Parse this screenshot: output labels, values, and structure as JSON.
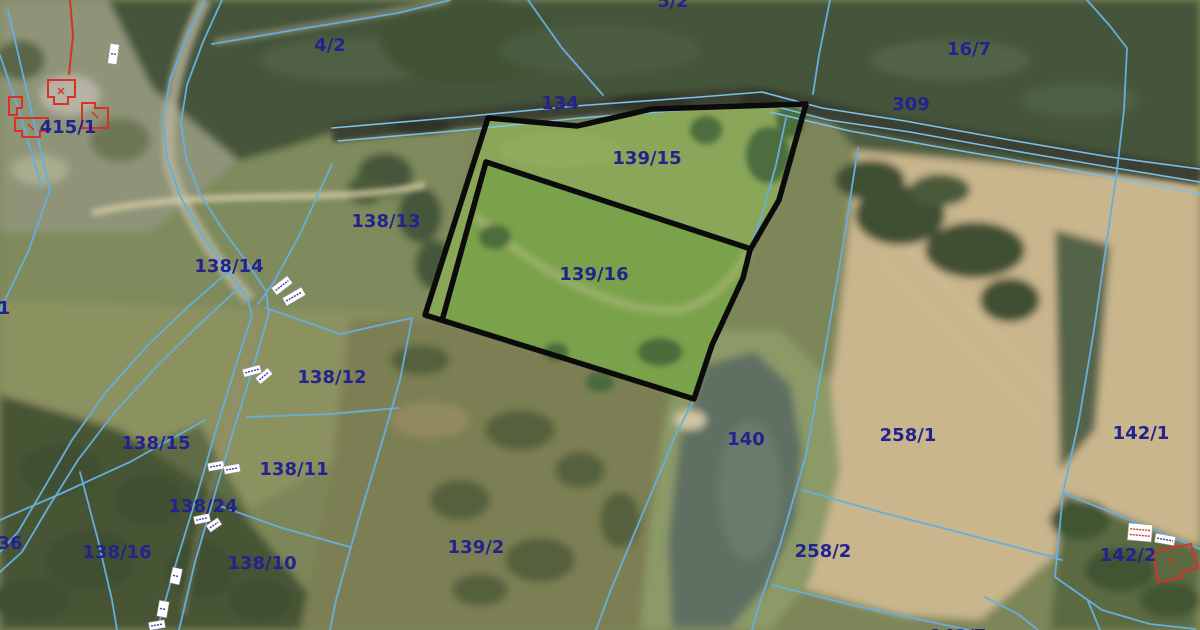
{
  "map": {
    "type": "cadastral-aerial-map",
    "highlighted_parcels": [
      "139/15",
      "139/16"
    ],
    "colors": {
      "boundary_line": "#66aede",
      "label_text": "#23238f",
      "highlight_outline": "#0b0b0b",
      "building_outline": "#d63226",
      "highlight_fill_north": "#8aa658",
      "highlight_fill_south": "#7aa24a"
    },
    "parcel_labels": [
      {
        "text": "415/1",
        "x": 68,
        "y": 128
      },
      {
        "text": "4/2",
        "x": 330,
        "y": 46
      },
      {
        "text": "5/2",
        "x": 673,
        "y": 2
      },
      {
        "text": "134",
        "x": 560,
        "y": 104
      },
      {
        "text": "309",
        "x": 911,
        "y": 105
      },
      {
        "text": "16/7",
        "x": 969,
        "y": 50
      },
      {
        "text": "139/15",
        "x": 647,
        "y": 159
      },
      {
        "text": "138/13",
        "x": 386,
        "y": 222
      },
      {
        "text": "138/14",
        "x": 229,
        "y": 267
      },
      {
        "text": "139/16",
        "x": 594,
        "y": 275
      },
      {
        "text": "138/12",
        "x": 332,
        "y": 378
      },
      {
        "text": "138/15",
        "x": 156,
        "y": 444
      },
      {
        "text": "138/11",
        "x": 294,
        "y": 470
      },
      {
        "text": "140",
        "x": 746,
        "y": 440
      },
      {
        "text": "258/1",
        "x": 908,
        "y": 436
      },
      {
        "text": "142/1",
        "x": 1141,
        "y": 434
      },
      {
        "text": "138/24",
        "x": 203,
        "y": 507
      },
      {
        "text": "138/16",
        "x": 117,
        "y": 553
      },
      {
        "text": "138/10",
        "x": 262,
        "y": 564
      },
      {
        "text": "36",
        "x": 10,
        "y": 544
      },
      {
        "text": "1",
        "x": 4,
        "y": 309
      },
      {
        "text": "139/2",
        "x": 476,
        "y": 548
      },
      {
        "text": "258/2",
        "x": 823,
        "y": 552
      },
      {
        "text": "142/2",
        "x": 1128,
        "y": 556
      },
      {
        "text": "142/7",
        "x": 958,
        "y": 637
      }
    ],
    "measurement_chips": [
      {
        "x": 109,
        "y": 44,
        "w": 9,
        "h": 20,
        "rot": 8,
        "ink": "#3b3bb0",
        "lines": 1
      },
      {
        "x": 272,
        "y": 281,
        "w": 20,
        "h": 9,
        "rot": -38,
        "ink": "#3b3bb0",
        "lines": 1
      },
      {
        "x": 283,
        "y": 292,
        "w": 22,
        "h": 9,
        "rot": -30,
        "ink": "#3b3bb0",
        "lines": 1
      },
      {
        "x": 243,
        "y": 367,
        "w": 18,
        "h": 8,
        "rot": -15,
        "ink": "#3b3bb0",
        "lines": 1
      },
      {
        "x": 256,
        "y": 372,
        "w": 16,
        "h": 8,
        "rot": -40,
        "ink": "#3b3bb0",
        "lines": 1
      },
      {
        "x": 208,
        "y": 462,
        "w": 16,
        "h": 8,
        "rot": -10,
        "ink": "#3b3bb0",
        "lines": 1
      },
      {
        "x": 224,
        "y": 465,
        "w": 16,
        "h": 8,
        "rot": -10,
        "ink": "#3b3bb0",
        "lines": 1
      },
      {
        "x": 194,
        "y": 515,
        "w": 16,
        "h": 8,
        "rot": -12,
        "ink": "#3b3bb0",
        "lines": 1
      },
      {
        "x": 207,
        "y": 521,
        "w": 14,
        "h": 8,
        "rot": -35,
        "ink": "#3b3bb0",
        "lines": 1
      },
      {
        "x": 171,
        "y": 568,
        "w": 10,
        "h": 16,
        "rot": 12,
        "ink": "#3b3bb0",
        "lines": 1
      },
      {
        "x": 158,
        "y": 601,
        "w": 10,
        "h": 16,
        "rot": 10,
        "ink": "#3b3bb0",
        "lines": 1
      },
      {
        "x": 149,
        "y": 621,
        "w": 16,
        "h": 8,
        "rot": -10,
        "ink": "#3b3bb0",
        "lines": 1
      },
      {
        "x": 1128,
        "y": 524,
        "w": 24,
        "h": 17,
        "rot": 5,
        "ink": "#c23a2a",
        "lines": 2
      },
      {
        "x": 1155,
        "y": 535,
        "w": 20,
        "h": 9,
        "rot": 10,
        "ink": "#3b3bb0",
        "lines": 1
      }
    ]
  }
}
